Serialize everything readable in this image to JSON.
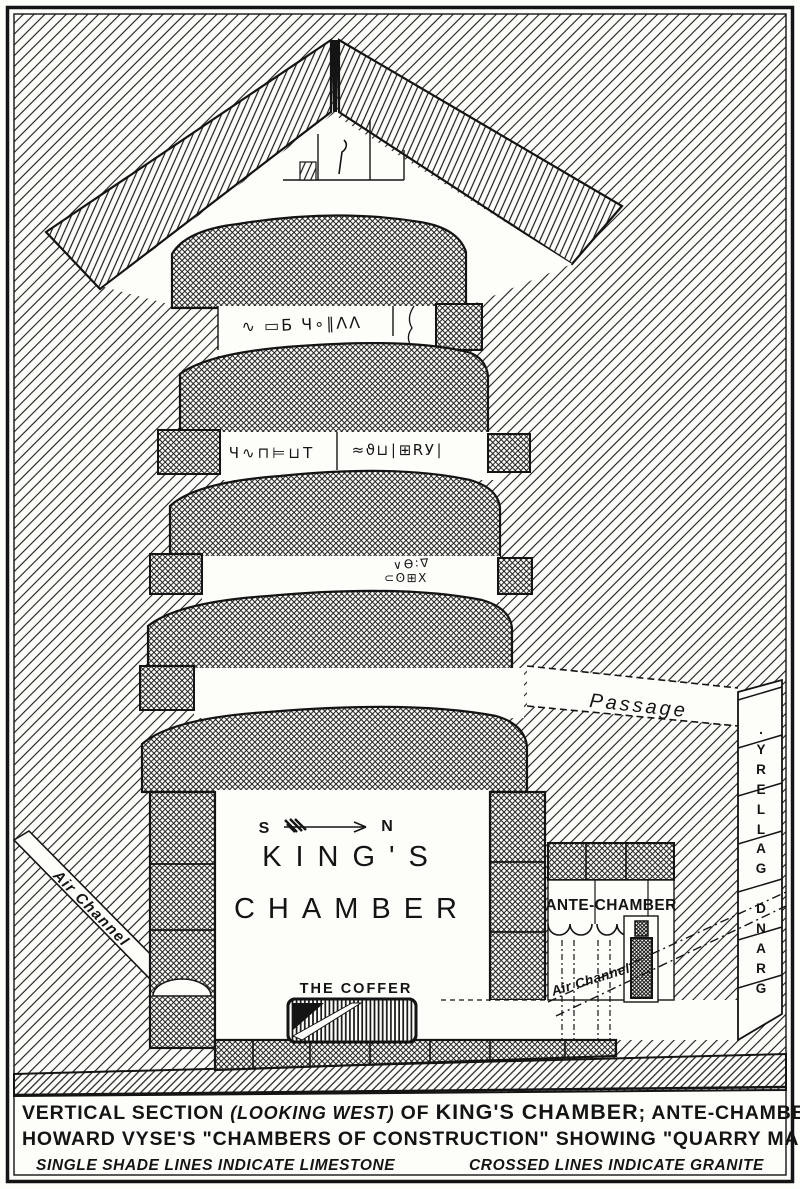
{
  "colors": {
    "ink": "#141414",
    "paper": "#fdfdfa"
  },
  "compass": {
    "south": "S",
    "north": "N"
  },
  "rooms": {
    "kings_chamber_line1": "KING'S",
    "kings_chamber_line2": "CHAMBER",
    "ante_chamber": "ANTE-CHAMBER",
    "grand_gallery": "GRAND GALLERY.",
    "passage": "Passage",
    "coffer": "THE COFFER",
    "air_channel_left": "Air Channel",
    "air_channel_right": "Air Channel"
  },
  "quarry_marks": {
    "band1": "∿ ▭Б Ч∘∥ΛΛ",
    "band2_left": "Ч∿⊓⊨⊔T",
    "band2_right": "≈ϑ⊔∣⊞RУ∣",
    "band3_line1": "∨ϴ∶∇",
    "band3_line2": "⊂ʘ⊞X"
  },
  "caption": {
    "line1_pre": "VERTICAL SECTION ",
    "line1_italic": "(LOOKING WEST)",
    "line1_mid": " OF ",
    "line1_big": "KING'S CHAMBER",
    "line1_tail": "; ANTE-CHAMBER AND",
    "line2": "HOWARD VYSE'S \"CHAMBERS OF CONSTRUCTION\" SHOWING \"QUARRY MARKS\"",
    "line3_left": "SINGLE SHADE LINES INDICATE LIMESTONE",
    "line3_right": "CROSSED LINES INDICATE GRANITE"
  }
}
